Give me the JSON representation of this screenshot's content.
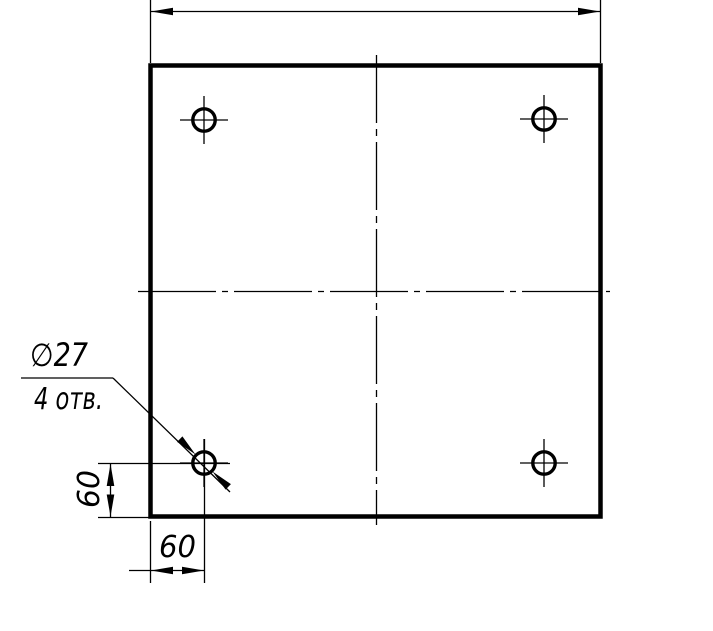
{
  "canvas": {
    "width": 713,
    "height": 631,
    "background": "#ffffff",
    "ink": "#000000",
    "thin_stroke": 1.3,
    "thick_stroke": 4.5,
    "circle_stroke": 3.4,
    "arrow_length": 22,
    "arrow_half_width": 3.8
  },
  "labels": {
    "hole_diameter": "∅27",
    "hole_count": "4 отв.",
    "dim_vertical": "60",
    "dim_horizontal": "60"
  },
  "geometry": {
    "plate": {
      "x": 150.5,
      "y": 65.5,
      "width": 450,
      "height": 451
    },
    "holes": {
      "radius": 11.2,
      "crosshair_extent": 24,
      "centers": [
        {
          "name": "hole-top-left",
          "cx": 204,
          "cy": 120
        },
        {
          "name": "hole-top-right",
          "cx": 544,
          "cy": 119
        },
        {
          "name": "hole-bottom-left",
          "cx": 204,
          "cy": 463
        },
        {
          "name": "hole-bottom-right",
          "cx": 544,
          "cy": 463
        }
      ]
    },
    "lines": [
      {
        "name": "top-dim-extension-left",
        "x1": 150.5,
        "y1": 0,
        "x2": 150.5,
        "y2": 63
      },
      {
        "name": "top-dim-extension-right",
        "x1": 600.5,
        "y1": 0,
        "x2": 600.5,
        "y2": 63
      },
      {
        "name": "top-dim-line",
        "x1": 150,
        "y1": 11.5,
        "x2": 601,
        "y2": 11.5
      },
      {
        "name": "centerline-horizontal",
        "x1": 138,
        "y1": 291.5,
        "x2": 610,
        "y2": 291.5,
        "dash": "78 6 6 6"
      },
      {
        "name": "centerline-vertical",
        "x1": 376.5,
        "y1": 55,
        "x2": 376.5,
        "y2": 525,
        "dash": "68 6 7 6"
      },
      {
        "name": "vdim-extension-top",
        "x1": 98,
        "y1": 463.5,
        "x2": 230,
        "y2": 463.5
      },
      {
        "name": "vdim-extension-bottom",
        "x1": 98,
        "y1": 517.5,
        "x2": 152,
        "y2": 517.5
      },
      {
        "name": "vdim-line",
        "x1": 110.5,
        "y1": 463,
        "x2": 110.5,
        "y2": 517
      },
      {
        "name": "hdim-extension-left",
        "x1": 150.5,
        "y1": 521,
        "x2": 150.5,
        "y2": 583
      },
      {
        "name": "hdim-extension-right",
        "x1": 204.5,
        "y1": 439,
        "x2": 204.5,
        "y2": 583
      },
      {
        "name": "hdim-line",
        "x1": 129,
        "y1": 570.5,
        "x2": 205,
        "y2": 570.5
      },
      {
        "name": "leader-shelf",
        "x1": 21,
        "y1": 378,
        "x2": 113,
        "y2": 378
      },
      {
        "name": "leader-diagonal",
        "x1": 113,
        "y1": 378,
        "x2": 230,
        "y2": 492
      }
    ],
    "arrows": [
      {
        "name": "top-dim-arrow-left",
        "x": 151,
        "y": 11.5,
        "angle": 180
      },
      {
        "name": "top-dim-arrow-right",
        "x": 600,
        "y": 11.5,
        "angle": 0
      },
      {
        "name": "vdim-arrow-up",
        "x": 110.5,
        "y": 464,
        "angle": 270
      },
      {
        "name": "vdim-arrow-down",
        "x": 110.5,
        "y": 516.5,
        "angle": 90
      },
      {
        "name": "hdim-arrow-left",
        "x": 151,
        "y": 570.5,
        "angle": 180
      },
      {
        "name": "hdim-arrow-right",
        "x": 204,
        "y": 570.5,
        "angle": 0
      },
      {
        "name": "leader-arrow-upper",
        "x": 195.5,
        "y": 454.5,
        "angle": 44.3
      },
      {
        "name": "leader-arrow-lower",
        "x": 212.5,
        "y": 471.5,
        "angle": 224.3
      }
    ],
    "texts": [
      {
        "name": "hole-diameter-label",
        "bind": "labels.hole_diameter",
        "x": 30,
        "y": 366,
        "size": 32,
        "length": 58
      },
      {
        "name": "hole-count-label",
        "bind": "labels.hole_count",
        "x": 34,
        "y": 409,
        "size": 30,
        "length": 69
      },
      {
        "name": "horizontal-dim-label",
        "bind": "labels.dim_horizontal",
        "x": 159,
        "y": 557,
        "size": 30,
        "length": 37
      },
      {
        "name": "vertical-dim-label",
        "bind": "labels.dim_vertical",
        "x": 0,
        "y": 0,
        "size": 30,
        "length": 38,
        "transform": "translate(99,508) rotate(-90)"
      }
    ]
  }
}
